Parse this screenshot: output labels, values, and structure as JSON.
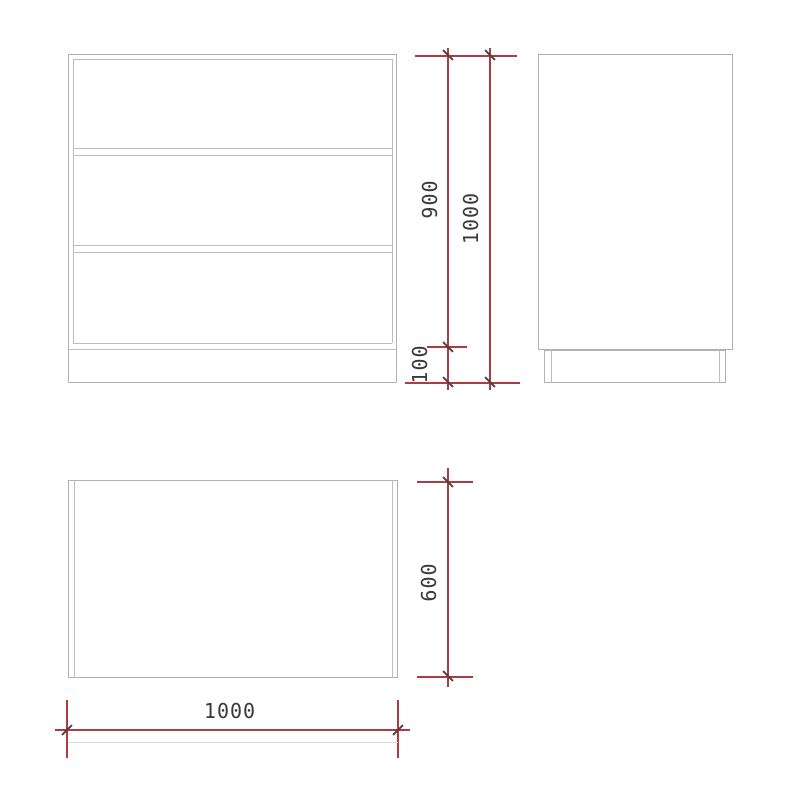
{
  "drawing": {
    "description": "orthographic furniture drawing with three views and red dimension lines",
    "dimensions": {
      "body_height": "900",
      "total_height": "1000",
      "plinth_height": "100",
      "depth": "600",
      "width": "1000"
    },
    "colors": {
      "background": "#ffffff",
      "outline": "#b2b2b2",
      "dimension_line": "#ae3b41",
      "tick": "#4c4043",
      "text": "#3a3a3a"
    }
  }
}
